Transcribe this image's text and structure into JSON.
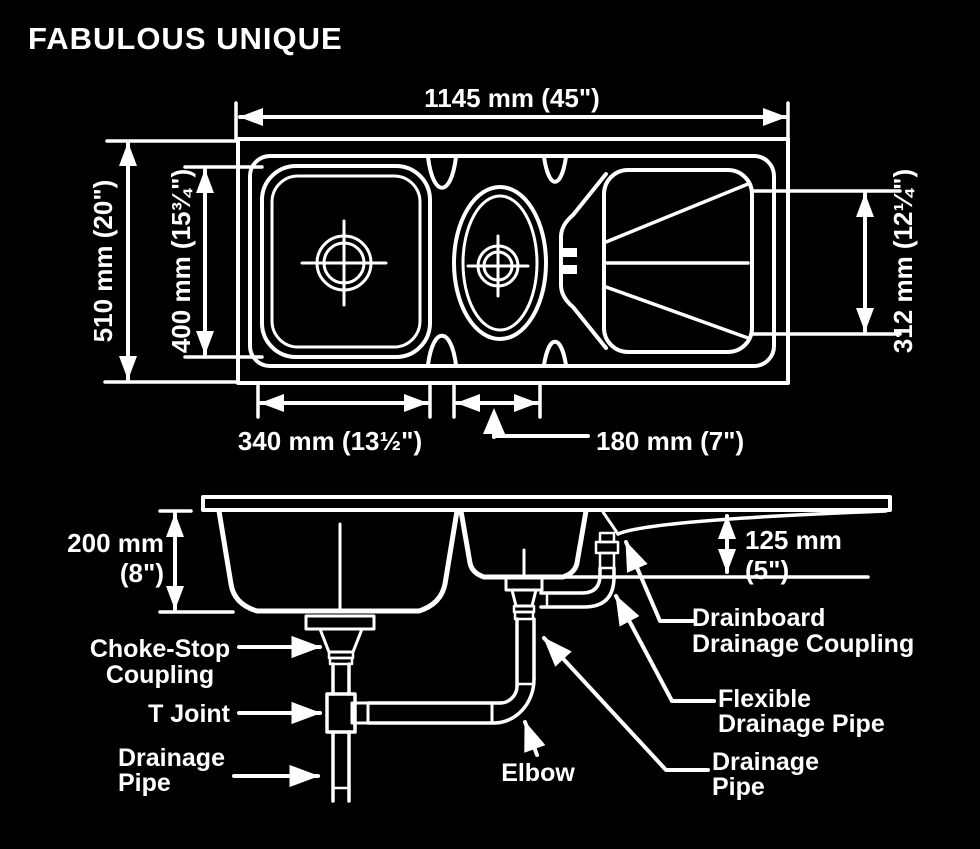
{
  "title": "FABULOUS UNIQUE",
  "colors": {
    "background": "#000000",
    "line": "#ffffff"
  },
  "top_view": {
    "width_overall": "1145 mm (45\")",
    "depth_overall": "510 mm (20\")",
    "bowl_length": "400 mm (15¾\")",
    "drainboard_length": "312 mm (12¼\")",
    "main_bowl_width": "340 mm (13½\")",
    "second_bowl_width": "180 mm (7\")"
  },
  "side_view": {
    "main_bowl_depth_line1": "200 mm",
    "main_bowl_depth_line2": "(8\")",
    "drainboard_depth_line1": "125 mm",
    "drainboard_depth_line2": "(5\")",
    "labels": {
      "choke_stop_line1": "Choke-Stop",
      "choke_stop_line2": "Coupling",
      "t_joint": "T Joint",
      "drainage_pipe_left_line1": "Drainage",
      "drainage_pipe_left_line2": "Pipe",
      "elbow": "Elbow",
      "drainboard_coupling_line1": "Drainboard",
      "drainboard_coupling_line2": "Drainage Coupling",
      "flexible_pipe_line1": "Flexible",
      "flexible_pipe_line2": "Drainage Pipe",
      "drainage_pipe_right_line1": "Drainage",
      "drainage_pipe_right_line2": "Pipe"
    }
  }
}
